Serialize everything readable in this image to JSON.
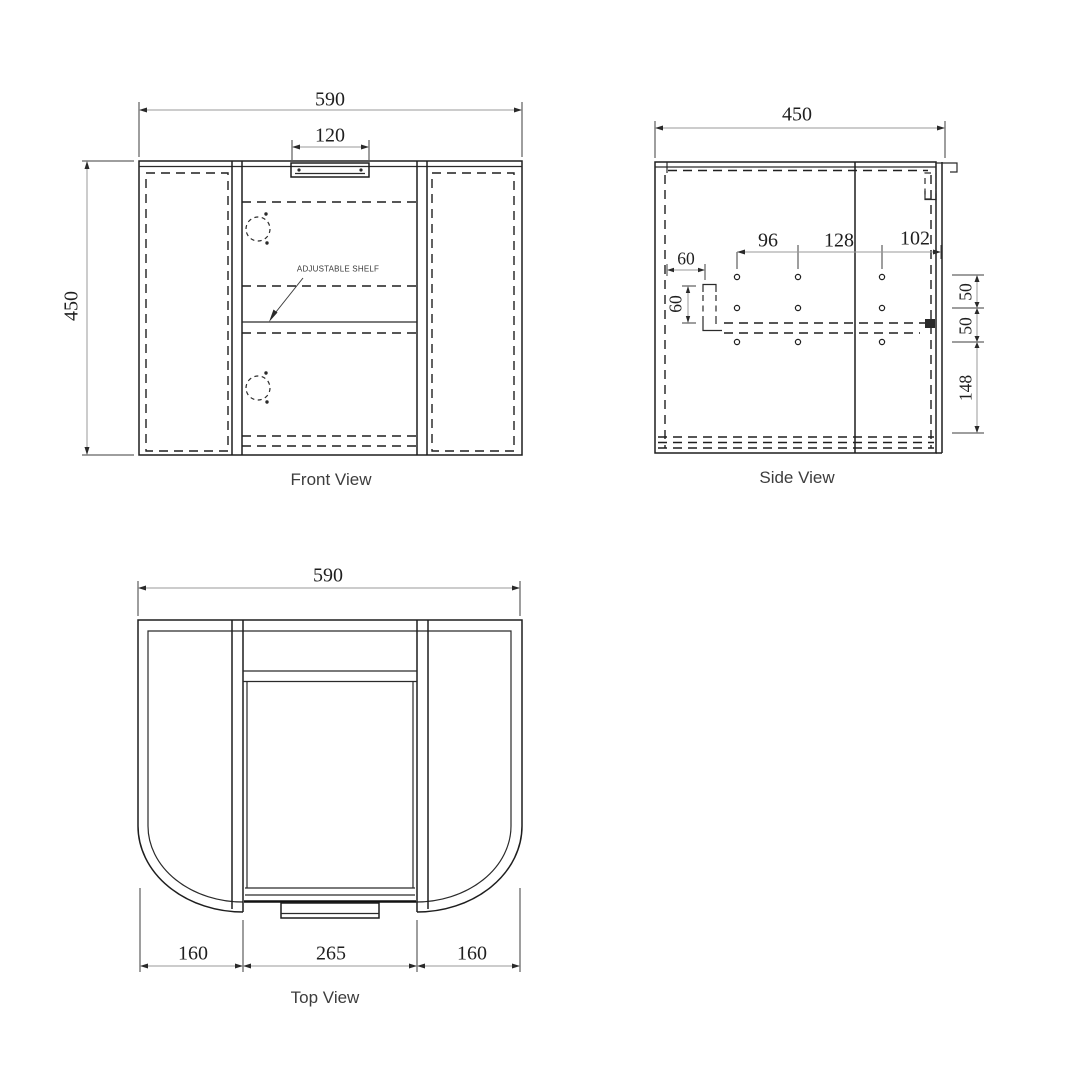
{
  "drawing": {
    "type": "cabinet-orthographic-technical-drawing",
    "colors": {
      "line": "#1e1e1e",
      "dim_line": "#9a9a9a",
      "dim_text": "#1f1f1f",
      "title_text": "#3d3d3d",
      "background": "#ffffff"
    },
    "views": {
      "front": {
        "title": "Front View",
        "annotation": "ADJUSTABLE SHELF",
        "dims": {
          "overall_width": "590",
          "handle_width": "120",
          "overall_height": "450"
        }
      },
      "side": {
        "title": "Side View",
        "dims": {
          "overall_depth": "450",
          "hole_pitch_1": "96",
          "hole_pitch_2": "128",
          "hole_to_front": "102",
          "bracket_offset_h": "60",
          "bracket_offset_v": "60",
          "row_gap_1": "50",
          "row_gap_2": "50",
          "bottom_offset": "148"
        }
      },
      "top": {
        "title": "Top View",
        "dims": {
          "overall_width": "590",
          "left_wing": "160",
          "door_width": "265",
          "right_wing": "160"
        }
      }
    }
  }
}
